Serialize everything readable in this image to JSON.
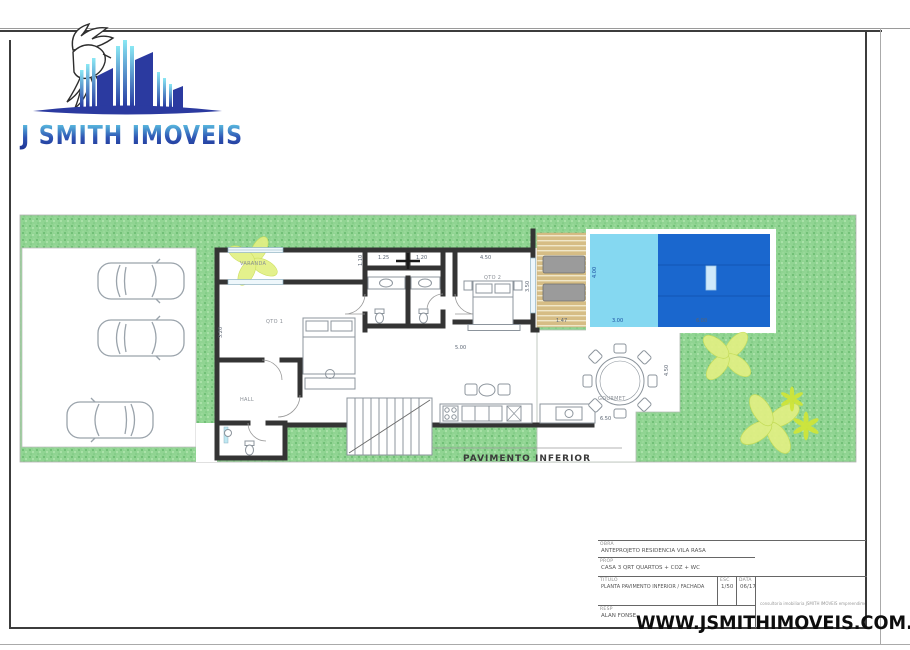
{
  "logo": {
    "brand": "J SMITH IMOVEIS"
  },
  "watermark": {
    "url": "WWW.JSMITHIMOVEIS.COM.BR"
  },
  "plan": {
    "caption": "PAVIMENTO INFERIOR",
    "rooms": {
      "varanda": "VARANDA",
      "qto1": "QTO 1",
      "qto2": "QTO 2",
      "hall": "HALL",
      "gourmet": "GOURMET"
    },
    "dims": {
      "d125": "1.25",
      "d120": "1.20",
      "d450": "4.50",
      "d450b": "4.50",
      "d350": "3.50",
      "d110": "1.10",
      "d320": "3.20",
      "d400": "4.00",
      "d147": "1.47",
      "d300": "3.00",
      "d600": "6.00",
      "d650": "6.50",
      "d500": "5.00"
    },
    "colors": {
      "grass": "#8fd191",
      "pool_light": "#85d8f1",
      "pool_dark": "#1a67ce",
      "deck": "#d6bd85",
      "wall": "#343434",
      "logo_blue": "#2b3aa0",
      "logo_cyan": "#7fe3f2"
    }
  },
  "titleblock": {
    "rows": [
      {
        "label": "OBRA",
        "text": "ANTEPROJETO RESIDENCIA VILA RASA"
      },
      {
        "label": "PROP",
        "text": "CASA 3 QRT QUARTOS + COZ + WC"
      },
      {
        "label": "TITULO",
        "text": "PLANTA PAVIMENTO INFERIOR / FACHADA"
      },
      {
        "label": "RESP",
        "text": "ALAN FONSE"
      }
    ],
    "esc_label": "ESC",
    "esc_value": "1/50",
    "date_label": "DATA",
    "date_value": "06/17",
    "side_note": "consultoria imobiliaria JSMITH IMOVEIS empreendimento villa rasa"
  }
}
